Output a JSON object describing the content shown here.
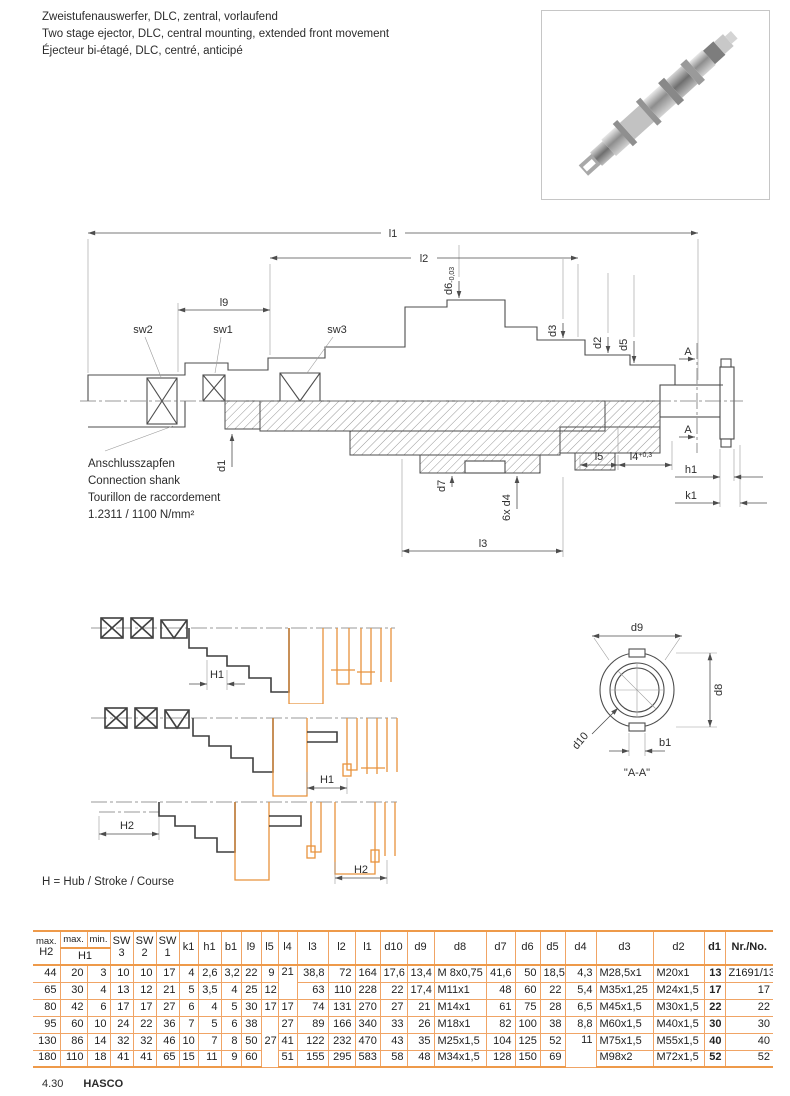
{
  "page": {
    "title_de": "Zweistufenauswerfer, DLC, zentral, vorlaufend",
    "title_en": "Two stage ejector, DLC, central mounting, extended front movement",
    "title_fr": "Éjecteur bi-étagé, DLC, centré, anticipé",
    "note": "H = Hub / Stroke / Course",
    "page_number": "4.30",
    "brand": "HASCO"
  },
  "drawing": {
    "l1": "l1",
    "l2": "l2",
    "l9": "l9",
    "sw1": "sw1",
    "sw2": "sw2",
    "sw3": "sw3",
    "d6": "d6",
    "d6_tol": "-0,03",
    "d3": "d3",
    "d2": "d2",
    "d5": "d5",
    "d1": "d1",
    "d7": "d7",
    "d4_count": "6x d4",
    "l3": "l3",
    "l5": "l5",
    "l4": "l4",
    "l4_tol": "+0,3",
    "h1": "h1",
    "k1": "k1",
    "section_mark": "A",
    "shank": [
      "Anschlusszapfen",
      "Connection shank",
      "Tourillon de raccordement",
      "1.2311 / 1100 N/mm²"
    ]
  },
  "section_view": {
    "d9": "d9",
    "d8": "d8",
    "d10": "d10",
    "b1": "b1",
    "caption": "\"A-A\""
  },
  "strokes": {
    "h1": "H1",
    "h2": "H2"
  },
  "table": {
    "headers": {
      "h2": {
        "top": "max.",
        "label": "H2"
      },
      "h1": {
        "max": "max.",
        "min": "min.",
        "label": "H1"
      },
      "sw": [
        {
          "top": "SW",
          "num": "3"
        },
        {
          "top": "SW",
          "num": "2"
        },
        {
          "top": "SW",
          "num": "1"
        }
      ],
      "cols": [
        "k1",
        "h1",
        "b1",
        "l9",
        "l5",
        "l4",
        "l3",
        "l2",
        "l1",
        "d10",
        "d9",
        "d8",
        "d7",
        "d6",
        "d5",
        "d4",
        "d3",
        "d2"
      ],
      "d1": "d1",
      "nr": "Nr./No."
    },
    "rows": [
      [
        "44",
        "20",
        "3",
        "10",
        "10",
        "17",
        "4",
        "2,6",
        "3,2",
        "22",
        "9",
        "21",
        "38,8",
        "72",
        "164",
        "17,6",
        "13,4",
        "M 8x0,75",
        "41,6",
        "50",
        "18,5",
        "4,3",
        "M28,5x1",
        "M20x1",
        "13",
        "Z1691/13"
      ],
      [
        "65",
        "30",
        "4",
        "13",
        "12",
        "21",
        "5",
        "3,5",
        "4",
        "25",
        "12",
        null,
        "63",
        "110",
        "228",
        "22",
        "17,4",
        "M11x1",
        "48",
        "60",
        "22",
        "5,4",
        "M35x1,25",
        "M24x1,5",
        "17",
        "17"
      ],
      [
        "80",
        "42",
        "6",
        "17",
        "17",
        "27",
        "6",
        "4",
        "5",
        "30",
        "17",
        "17",
        "74",
        "131",
        "270",
        "27",
        "21",
        "M14x1",
        "61",
        "75",
        "28",
        "6,5",
        "M45x1,5",
        "M30x1,5",
        "22",
        "22"
      ],
      [
        "95",
        "60",
        "10",
        "24",
        "22",
        "36",
        "7",
        "5",
        "6",
        "38",
        "27",
        "27",
        "89",
        "166",
        "340",
        "33",
        "26",
        "M18x1",
        "82",
        "100",
        "38",
        "8,8",
        "M60x1,5",
        "M40x1,5",
        "30",
        "30"
      ],
      [
        "130",
        "86",
        "14",
        "32",
        "32",
        "46",
        "10",
        "7",
        "8",
        "50",
        null,
        "41",
        "122",
        "232",
        "470",
        "43",
        "35",
        "M25x1,5",
        "104",
        "125",
        "52",
        "11",
        "M75x1,5",
        "M55x1,5",
        "40",
        "40"
      ],
      [
        "180",
        "110",
        "18",
        "41",
        "41",
        "65",
        "15",
        "11",
        "9",
        "60",
        null,
        "51",
        "155",
        "295",
        "583",
        "58",
        "48",
        "M34x1,5",
        "128",
        "150",
        "69",
        null,
        "M98x2",
        "M72x1,5",
        "52",
        "52"
      ]
    ],
    "merges": [
      {
        "row": 0,
        "col": 11,
        "rowspan": 2,
        "valign": "top"
      },
      {
        "row": 3,
        "col": 10,
        "rowspan": 3,
        "valign": "middle"
      },
      {
        "row": 4,
        "col": 21,
        "rowspan": 2,
        "valign": "top"
      }
    ]
  }
}
